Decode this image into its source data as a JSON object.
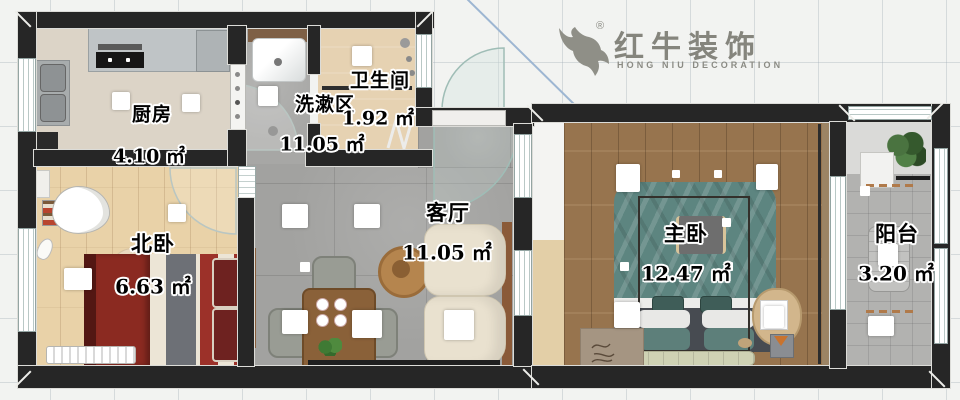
{
  "brand": {
    "name": "红牛装饰",
    "subtitle": "HONG NIU DECORATION",
    "registered": "®"
  },
  "rooms": [
    {
      "id": "kitchen",
      "name": "厨房",
      "area": "4.10 ㎡"
    },
    {
      "id": "washroom",
      "name": "洗漱区",
      "area": "11.05 ㎡"
    },
    {
      "id": "bathroom",
      "name": "卫生间",
      "area": "1.92 ㎡"
    },
    {
      "id": "north-bedroom",
      "name": "北卧",
      "area": "6.63 ㎡"
    },
    {
      "id": "living-room",
      "name": "客厅",
      "area": "11.05 ㎡"
    },
    {
      "id": "master-bedroom",
      "name": "主卧",
      "area": "12.47 ㎡"
    },
    {
      "id": "balcony",
      "name": "阳台",
      "area": "3.20 ㎡"
    }
  ],
  "colors": {
    "wall": "#262626",
    "brand_gray": "#85857d",
    "wood_light": "#e9d2a8",
    "wood_dark": "#97744e",
    "tile_gray": "#a2a2a0",
    "bath_beige": "#e6d2b2",
    "accent_blue": "#9db6d2",
    "sofa_cream": "#e9e1cf",
    "bed_teal": "#5d8580",
    "bed_red": "#8b2a21",
    "door_glass": "#9fbdb6"
  }
}
